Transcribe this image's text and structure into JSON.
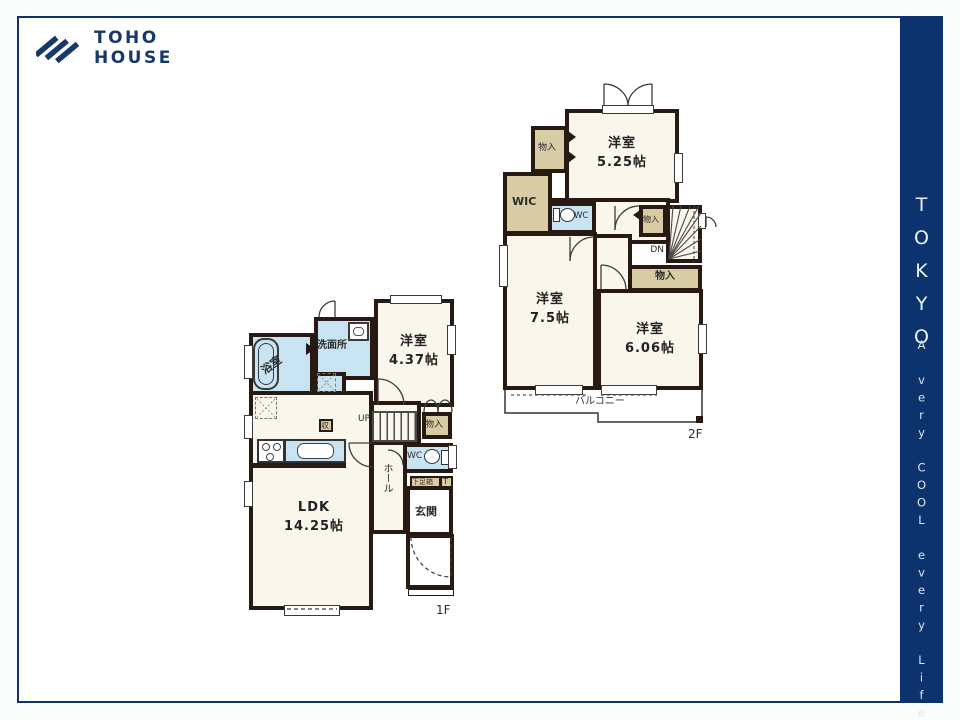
{
  "header": {
    "logo_line1": "TOHO",
    "logo_line2": "HOUSE"
  },
  "sidebar": {
    "title": "TOKYO",
    "tagline": "A very COOL every Life!"
  },
  "colors": {
    "brand_navy": "#0c336e",
    "wall_dark": "#281a12",
    "closet_beige": "#d7cca4",
    "wet_area_blue": "#c8e4f2",
    "floor_cream": "#f9f6ec"
  },
  "floor1": {
    "floor_label": "1F",
    "ldk_name": "LDK",
    "ldk_size": "14.25帖",
    "bath_label": "浴室",
    "washroom_label": "洗面所",
    "bedroom_name": "洋室",
    "bedroom_size": "4.37帖",
    "entrance_label": "玄関",
    "hall_label": "ホール",
    "wc_label": "WC",
    "shoebox_label": "下足箱",
    "shoebox_t_label": "T",
    "storage_label": "収",
    "closet_label": "物入",
    "stairs_label": "UP"
  },
  "floor2": {
    "floor_label": "2F",
    "bedroom1_name": "洋室",
    "bedroom1_size": "5.25帖",
    "bedroom2_name": "洋室",
    "bedroom2_size": "7.5帖",
    "bedroom3_name": "洋室",
    "bedroom3_size": "6.06帖",
    "wic_label": "WIC",
    "wc_label": "WC",
    "closet_a_label": "物入",
    "closet_b_label": "物入",
    "closet_c_label": "物入",
    "stairs_label": "DN",
    "balcony_label": "バルコニー"
  }
}
